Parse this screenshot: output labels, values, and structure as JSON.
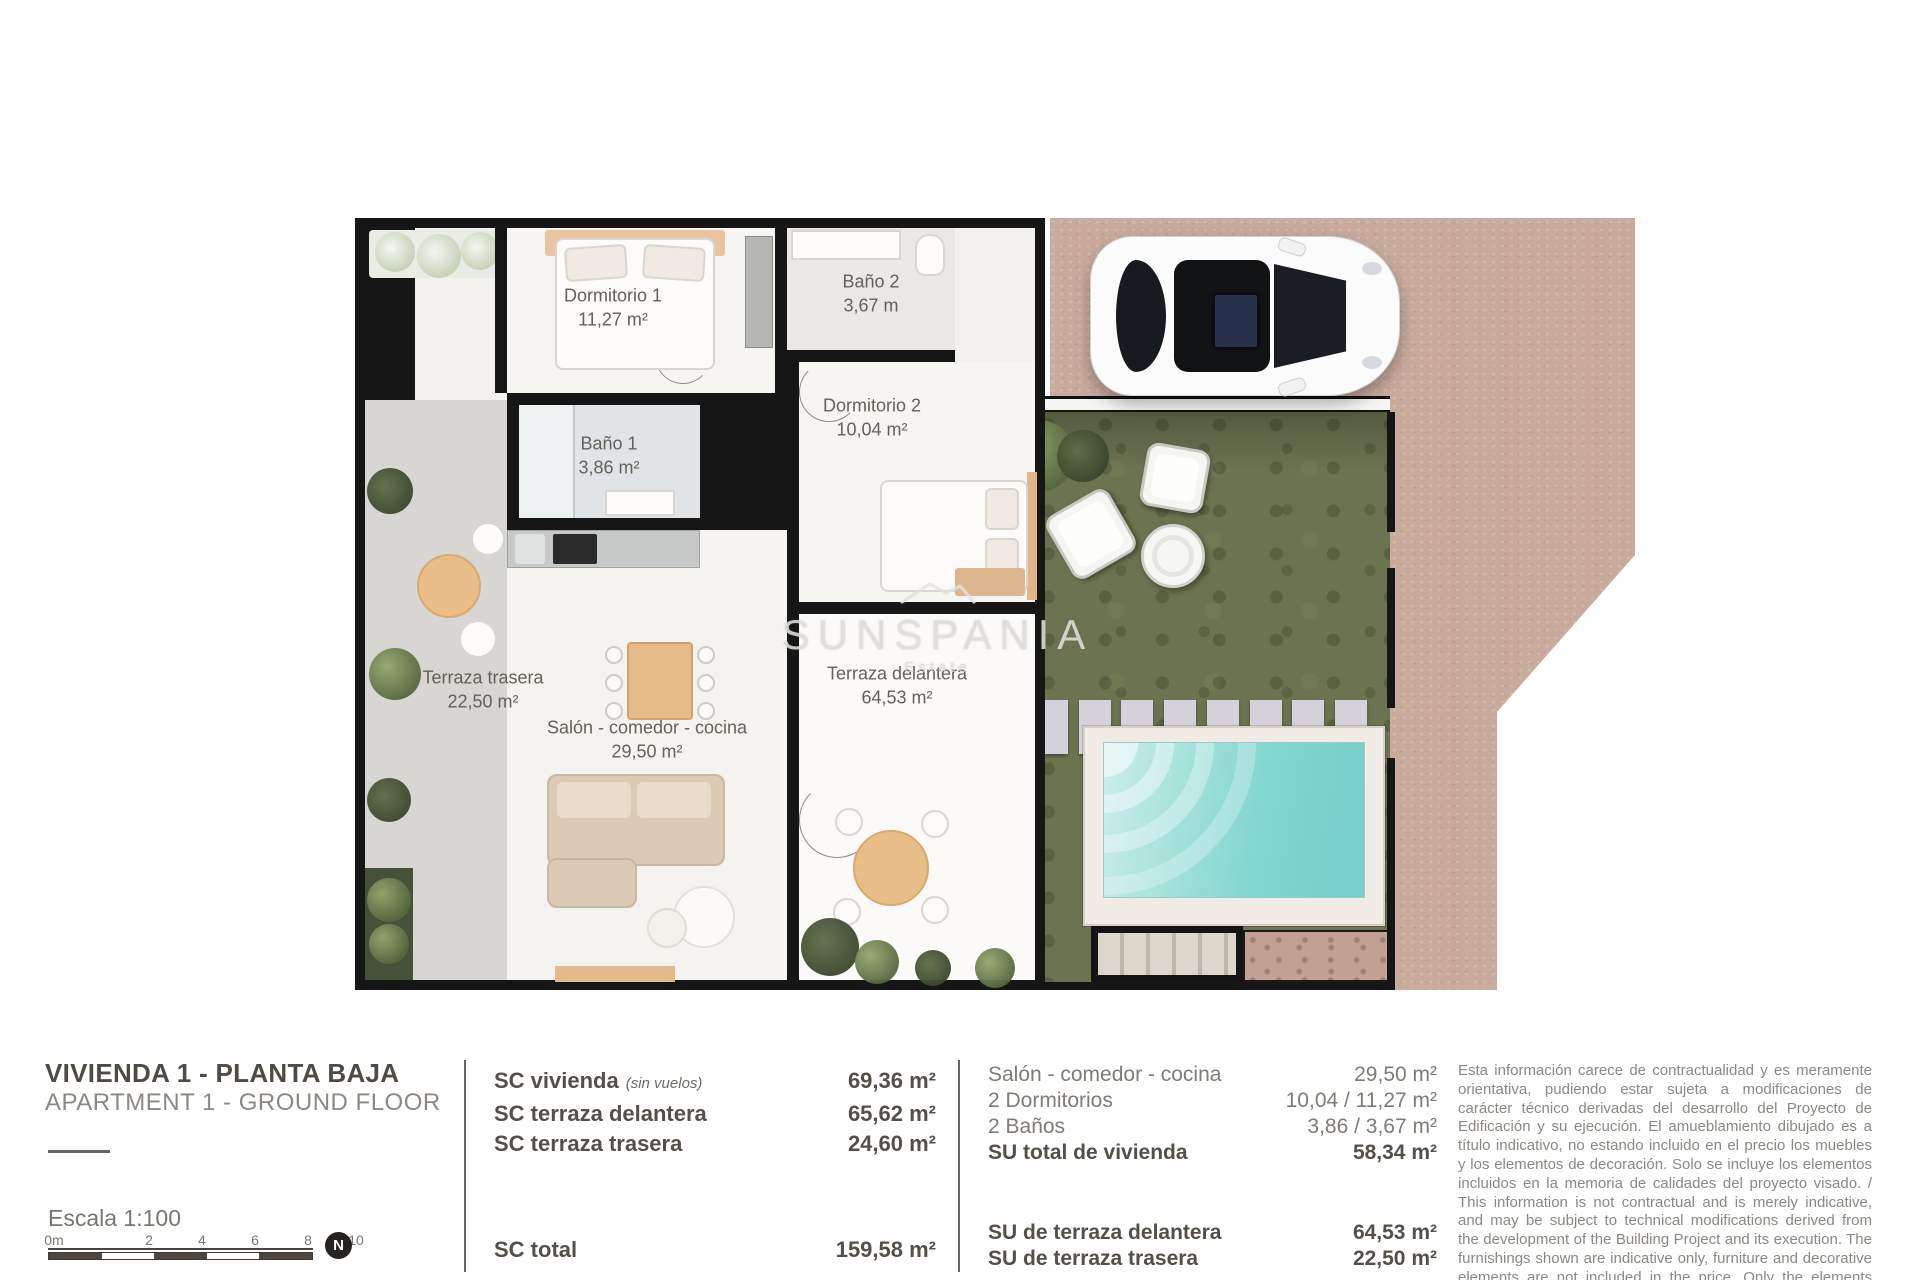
{
  "plan": {
    "watermark": {
      "brand": "SUNSPANIA",
      "sub": "Estate"
    },
    "rooms": [
      {
        "name": "Dormitorio 1",
        "area": "11,27 m²"
      },
      {
        "name": "Baño 2",
        "area": "3,67 m"
      },
      {
        "name": "Baño 1",
        "area": "3,86 m²"
      },
      {
        "name": "Dormitorio 2",
        "area": "10,04 m²"
      },
      {
        "name": "Terraza trasera",
        "area": "22,50 m²"
      },
      {
        "name": "Salón - comedor - cocina",
        "area": "29,50 m²"
      },
      {
        "name": "Terraza delantera",
        "area": "64,53 m²"
      }
    ]
  },
  "info": {
    "title": "VIVIENDA 1 - PLANTA BAJA",
    "subtitle": "APARTMENT 1 - GROUND FLOOR",
    "scale": {
      "label": "Escala 1:100",
      "ticks": [
        "0m",
        "2",
        "4",
        "6",
        "8",
        "10"
      ],
      "north": "N"
    },
    "sc": {
      "rows": [
        {
          "label": "SC vivienda",
          "note": "(sin vuelos)",
          "value": "69,36 m²"
        },
        {
          "label": "SC terraza delantera",
          "note": "",
          "value": "65,62 m²"
        },
        {
          "label": "SC terraza trasera",
          "note": "",
          "value": "24,60 m²"
        }
      ],
      "total_label": "SC total",
      "total_value": "159,58 m²"
    },
    "su": {
      "rows": [
        {
          "label": "Salón - comedor - cocina",
          "value": "29,50 m²"
        },
        {
          "label": "2 Dormitorios",
          "value": "10,04 / 11,27 m²"
        },
        {
          "label": "2 Baños",
          "value": "3,86 / 3,67 m²"
        },
        {
          "label": "SU total de vivienda",
          "value": "58,34 m²"
        }
      ],
      "terrace_rows": [
        {
          "label": "SU de terraza delantera",
          "value": "64,53 m²"
        },
        {
          "label": "SU de terraza trasera",
          "value": "22,50 m²"
        }
      ]
    },
    "disclaimer": "Esta información carece de contractualidad y es meramente orientativa, pudiendo estar sujeta a modificaciones de carácter técnico derivadas del desarrollo del Proyecto de Edificación y su ejecución. El amueblamiento dibujado es a título indicativo, no estando incluido en el precio los muebles y los elementos de decoración. Solo se incluye los elementos incluidos en la memoria de calidades del proyecto visado. / This information is not contractual and is merely indicative, and may be subject to technical modifications derived from the development of the Building Project and its execution. The furnishings shown are indicative only, furniture and decorative elements are not included in the price. Only the elements included in the quality specifications of the approved project are included."
  },
  "colors": {
    "wall": "#161616",
    "paving_tan": "#c9ab9e",
    "grass_green": "#6b7350",
    "pool_turquoise": "#83d6d1",
    "wood_tan": "#e7bb87",
    "text_dark": "#554f49",
    "text_light": "#8c8781"
  }
}
